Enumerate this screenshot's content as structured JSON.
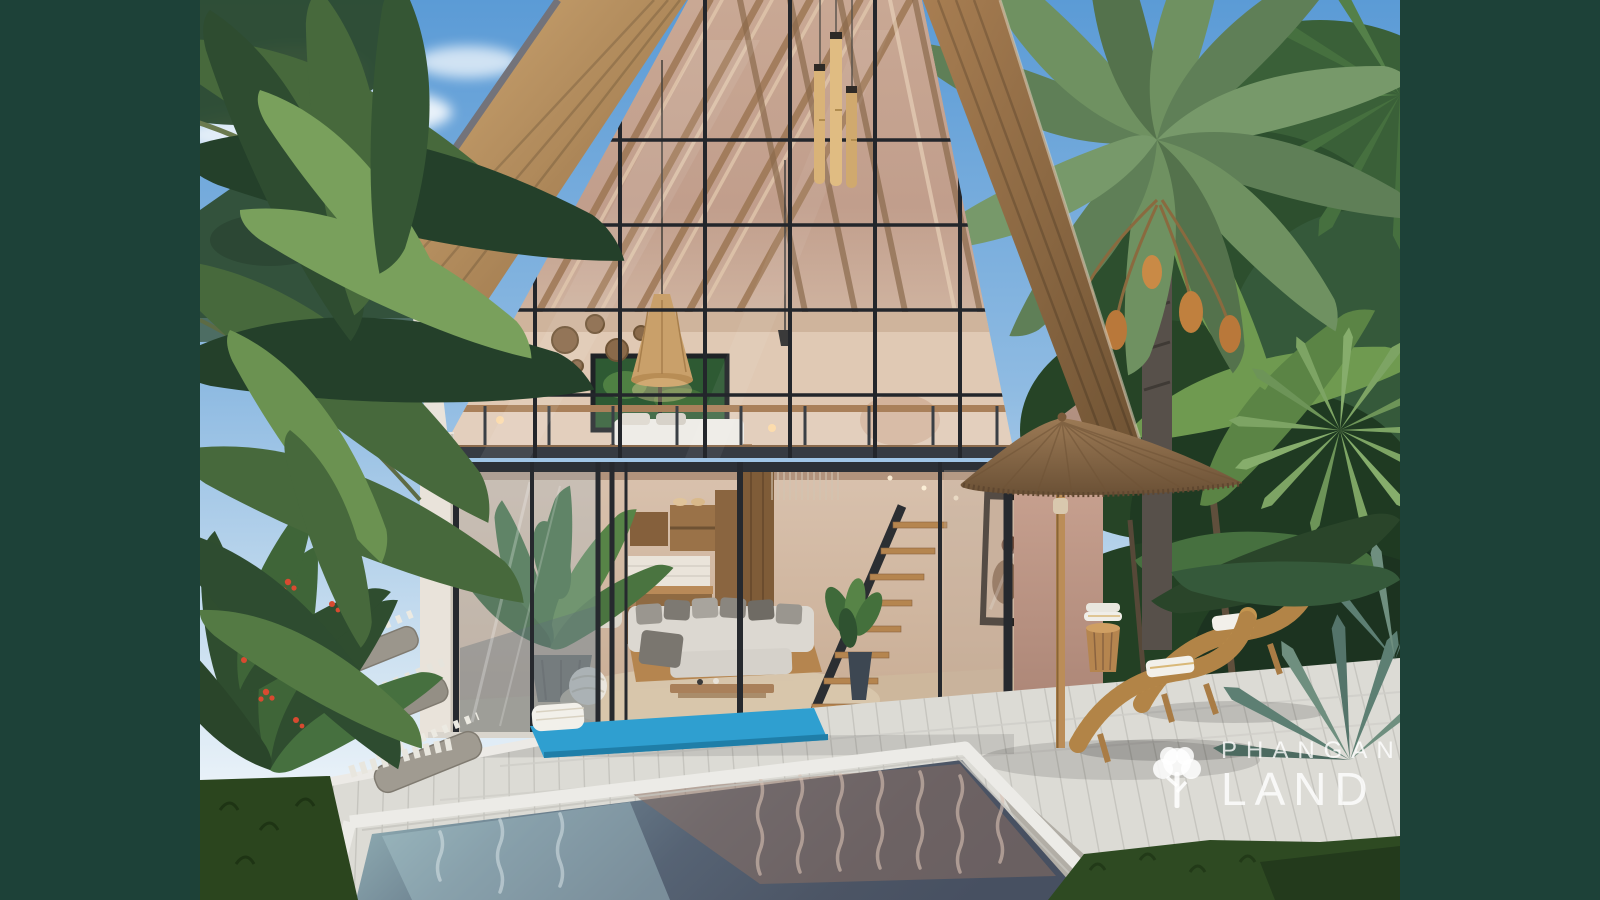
{
  "image": {
    "kind": "architectural-exterior-render",
    "subject": "Tropical A-frame glass villa with loft bedroom, jungle garden, thatched parasol, wooden sun loungers and plunge pool on a white timber deck"
  },
  "watermark": {
    "line1": "PHANGAN",
    "line2": "LAND",
    "logo_icon": "tree-icon"
  },
  "scene": {
    "elements": [
      "sky",
      "clouds",
      "mountain-ridge",
      "date-palm",
      "jungle-foliage",
      "a-frame-roof",
      "glass-gable-facade",
      "loft-bedroom",
      "pendant-lamp",
      "bamboo-wind-chimes",
      "living-room-sofa",
      "kitchen-shelves",
      "dining-set",
      "floating-staircase",
      "portrait-artwork",
      "sliding-glass-doors",
      "white-deck",
      "plunge-pool",
      "yoga-mat",
      "thatched-umbrella",
      "sun-loungers",
      "towel-barrel-table",
      "pebble-steps",
      "red-berry-shrub",
      "lawn"
    ]
  },
  "palette": {
    "frame_green": "#1d4138",
    "sky_top": "#5b9bd6",
    "sky_bottom": "#e8f1f8",
    "roof_light": "#cfa873",
    "roof_dark": "#8f6a42",
    "glass_warm": "#c9a894",
    "interior_wall": "#dcc4ae",
    "wood": "#a97c4e",
    "deck": "#dcdbd5",
    "pool_deep": "#4c5565",
    "pool_teal": "#9cbcc0",
    "reflection_mauve": "#8d7062",
    "thatch": "#8f6f4e",
    "lounger": "#c3944f",
    "mat_blue": "#2f9fd0",
    "foliage_dark": "#24402a",
    "foliage_mid": "#47693c",
    "foliage_light": "#79a05c",
    "berry_red": "#d84a30",
    "watermark": "#ffffff"
  }
}
